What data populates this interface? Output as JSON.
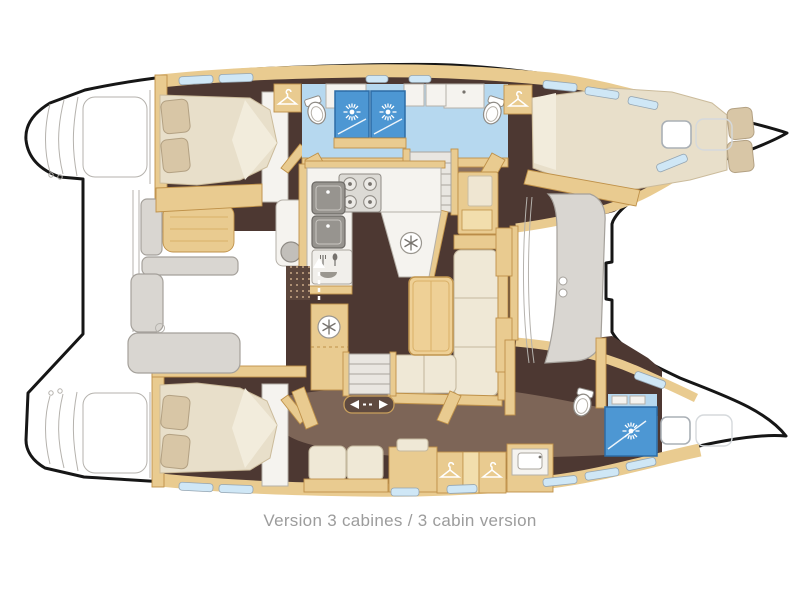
{
  "figure": {
    "caption": "Version 3 cabines / 3 cabin version"
  },
  "palette": {
    "outline": "#161616",
    "floor": "#4d3832",
    "floor_light": "#8a7060",
    "wood": "#e9cb90",
    "wood_edge": "#bf9149",
    "wood_light": "#f2dead",
    "mattress": "#e8dfca",
    "pillow": "#d8c6a6",
    "cushion": "#efe8d6",
    "cushion_edge": "#c5b99f",
    "shower": "#4d97d3",
    "shower_edge": "#2d6ca6",
    "bath_floor": "#b6d8ef",
    "window": "#cfe7f6",
    "counter": "#f5f3ef",
    "gray_seat": "#d9d6d1",
    "sketch": "#b5b2ad",
    "appliance": "#97948f",
    "door_pill": "#5f4a40",
    "mat_dots": "#5c463c",
    "caption": "#9c9c9c"
  },
  "icons": {
    "shower_spray": "white sunburst rays",
    "clothes_hanger": "white coat hanger",
    "fridge_snowflake": "6-spoke snowflake in circle",
    "toilet": "oval bowl with tank",
    "stove_burners": "four gas rings",
    "cutlery": "fork, plate, spoon",
    "sliding_door": "left-right white arrows",
    "entry_door": "up arrow with dashed tail"
  }
}
